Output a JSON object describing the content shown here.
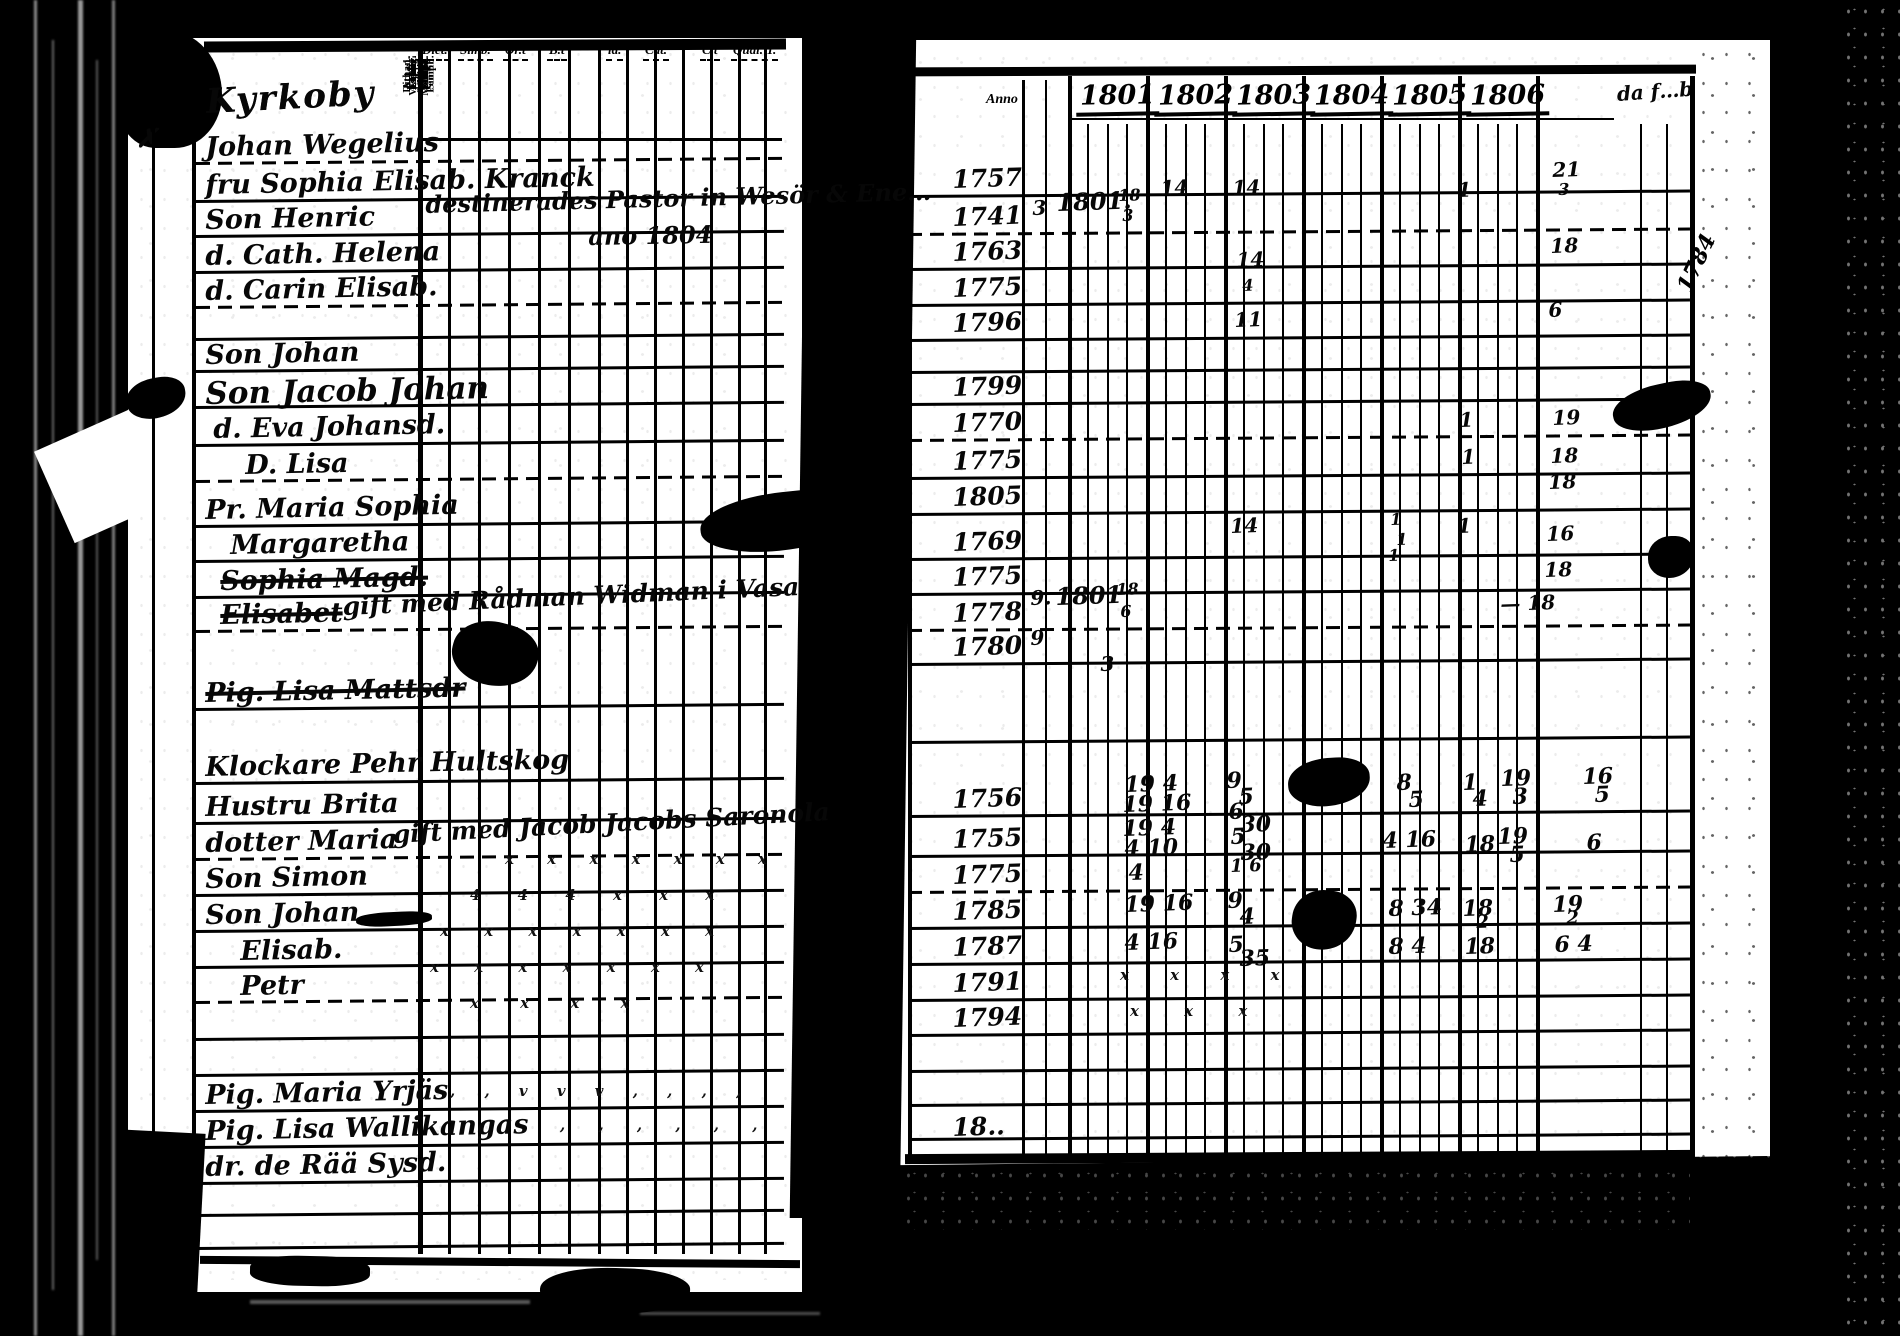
{
  "palette": {
    "film_black": "#000000",
    "paper_white": "#ffffff",
    "ink_black": "#070707"
  },
  "left_page": {
    "place_header": "Kyrkoby",
    "margin_cross": "✗",
    "group_labels": [
      {
        "text": "Dict.",
        "left": 420
      },
      {
        "text": "Simb.",
        "left": 458
      },
      {
        "text": "Or.t",
        "left": 503
      },
      {
        "text": "B.t",
        "left": 547
      },
      {
        "text": "lä.",
        "left": 606
      },
      {
        "text": "Cat.",
        "left": 643
      },
      {
        "text": "C.t",
        "left": 700
      },
      {
        "text": "Qual. T.",
        "left": 731
      }
    ],
    "rotated_columns": [
      "Explic.\nSimpl.",
      "Athan.\nExplic.\nSimpl.",
      "Explic.\nSimpl.",
      "Explic.\nSimpl.",
      "Explic.\nSimpl.",
      "Explic.\nSimpl.",
      "1.  2.  3.",
      "Thur.\nExpl.",
      "Utan.\nböned.",
      "Vespert.\nMatut.",
      "Dict. s.s.\nPennin.",
      "Allg. m."
    ],
    "annotations": [
      {
        "text": "destinerades Pastor in Wesör & Ene…",
        "x": 425,
        "y": 190,
        "size": 24,
        "rot": -1.5
      },
      {
        "text": "ano 1804",
        "x": 588,
        "y": 222,
        "size": 24,
        "rot": -1
      },
      {
        "text": "gift med Rådman Widman i Vasa",
        "x": 342,
        "y": 592,
        "size": 25,
        "rot": -2.5
      },
      {
        "text": "gift med Jacob Jacobs Saronola",
        "x": 392,
        "y": 820,
        "size": 25,
        "rot": -3
      }
    ],
    "checks": [
      {
        "t": "x  x x   x  x    x   x",
        "x": 505,
        "y": 850,
        "ls": 14
      },
      {
        "t": "4  4 4   x  x    x",
        "x": 470,
        "y": 886,
        "ls": 16
      },
      {
        "t": "x x  x   x x   x  x",
        "x": 440,
        "y": 922,
        "ls": 15
      },
      {
        "t": "x  x x x   x   x x",
        "x": 430,
        "y": 958,
        "ls": 15
      },
      {
        "t": "x x   x  x",
        "x": 470,
        "y": 994,
        "ls": 18
      },
      {
        "t": ", ,  v v v   , ,   , ,",
        "x": 450,
        "y": 1082,
        "ls": 12
      },
      {
        "t": ", ,   , ,    , ,",
        "x": 560,
        "y": 1116,
        "ls": 14
      },
      {
        "t": "x  x   x x",
        "x": 1120,
        "y": 966,
        "ls": 18
      },
      {
        "t": "x x    x",
        "x": 1130,
        "y": 1002,
        "ls": 20
      }
    ]
  },
  "right_page": {
    "anno_label": "Anno",
    "year_headers": [
      "1801",
      "1802",
      "1803",
      "1804",
      "1805",
      "1806"
    ],
    "last_column_label": "da f…b",
    "margin_notes": [
      {
        "text": "1784",
        "x": 1666,
        "y": 250,
        "rot": -65,
        "size": 22
      }
    ],
    "marks": [
      {
        "t": "3",
        "x": 1032,
        "y": 196
      },
      {
        "t": "1801.",
        "x": 1056,
        "y": 188,
        "s": 24
      },
      {
        "t": "18",
        "x": 1118,
        "y": 186,
        "s": 16
      },
      {
        "t": "3",
        "x": 1122,
        "y": 206,
        "s": 16
      },
      {
        "t": "14",
        "x": 1160,
        "y": 176
      },
      {
        "t": "14",
        "x": 1232,
        "y": 176
      },
      {
        "t": "14",
        "x": 1236,
        "y": 248
      },
      {
        "t": "4",
        "x": 1242,
        "y": 276,
        "s": 16
      },
      {
        "t": "11",
        "x": 1234,
        "y": 308
      },
      {
        "t": "1",
        "x": 1457,
        "y": 178
      },
      {
        "t": "21",
        "x": 1552,
        "y": 158
      },
      {
        "t": "3",
        "x": 1558,
        "y": 180,
        "s": 16
      },
      {
        "t": "18",
        "x": 1550,
        "y": 234
      },
      {
        "t": "6",
        "x": 1548,
        "y": 298
      },
      {
        "t": "1",
        "x": 1459,
        "y": 408
      },
      {
        "t": "19",
        "x": 1552,
        "y": 406
      },
      {
        "t": "1",
        "x": 1461,
        "y": 445
      },
      {
        "t": "18",
        "x": 1550,
        "y": 444
      },
      {
        "t": "18",
        "x": 1548,
        "y": 470
      },
      {
        "t": "14",
        "x": 1230,
        "y": 514
      },
      {
        "t": "1",
        "x": 1390,
        "y": 510,
        "s": 16
      },
      {
        "t": "1",
        "x": 1396,
        "y": 530,
        "s": 16
      },
      {
        "t": "1",
        "x": 1457,
        "y": 514
      },
      {
        "t": "16",
        "x": 1546,
        "y": 522
      },
      {
        "t": "1",
        "x": 1388,
        "y": 546,
        "s": 16
      },
      {
        "t": "18",
        "x": 1544,
        "y": 558
      },
      {
        "t": "9.",
        "x": 1030,
        "y": 586
      },
      {
        "t": "1801",
        "x": 1055,
        "y": 582,
        "s": 24
      },
      {
        "t": "18",
        "x": 1116,
        "y": 580,
        "s": 16
      },
      {
        "t": "6",
        "x": 1120,
        "y": 602,
        "s": 16
      },
      {
        "t": "— 18",
        "x": 1500,
        "y": 592
      },
      {
        "t": "9",
        "x": 1030,
        "y": 626
      },
      {
        "t": "3",
        "x": 1100,
        "y": 652
      },
      {
        "t": "19 4",
        "x": 1124,
        "y": 772,
        "s": 22
      },
      {
        "t": "19 16",
        "x": 1122,
        "y": 792,
        "s": 22
      },
      {
        "t": "9",
        "x": 1226,
        "y": 768,
        "s": 22
      },
      {
        "t": "5",
        "x": 1238,
        "y": 784,
        "s": 22
      },
      {
        "t": "6",
        "x": 1228,
        "y": 799,
        "s": 22
      },
      {
        "t": "30",
        "x": 1240,
        "y": 812,
        "s": 22
      },
      {
        "t": "8",
        "x": 1396,
        "y": 770,
        "s": 22
      },
      {
        "t": "5",
        "x": 1408,
        "y": 787,
        "s": 22
      },
      {
        "t": "1",
        "x": 1462,
        "y": 770,
        "s": 22
      },
      {
        "t": "4",
        "x": 1472,
        "y": 786,
        "s": 22
      },
      {
        "t": "19",
        "x": 1500,
        "y": 766,
        "s": 22
      },
      {
        "t": "3",
        "x": 1512,
        "y": 784,
        "s": 22
      },
      {
        "t": "16",
        "x": 1582,
        "y": 764,
        "s": 22
      },
      {
        "t": "5",
        "x": 1594,
        "y": 782,
        "s": 22
      },
      {
        "t": "19 4",
        "x": 1122,
        "y": 816,
        "s": 22
      },
      {
        "t": "4 10",
        "x": 1124,
        "y": 836,
        "s": 22
      },
      {
        "t": "5",
        "x": 1230,
        "y": 824,
        "s": 22
      },
      {
        "t": "30",
        "x": 1240,
        "y": 840,
        "s": 22
      },
      {
        "t": "4 16",
        "x": 1382,
        "y": 828,
        "s": 22
      },
      {
        "t": "18",
        "x": 1464,
        "y": 832,
        "s": 22
      },
      {
        "t": "19",
        "x": 1497,
        "y": 824,
        "s": 22
      },
      {
        "t": "5",
        "x": 1509,
        "y": 842,
        "s": 22
      },
      {
        "t": "6",
        "x": 1586,
        "y": 830,
        "s": 22
      },
      {
        "t": "4",
        "x": 1128,
        "y": 860,
        "s": 22
      },
      {
        "t": "1 6",
        "x": 1230,
        "y": 856,
        "s": 18
      },
      {
        "t": "19 16",
        "x": 1124,
        "y": 892,
        "s": 22
      },
      {
        "t": "9",
        "x": 1227,
        "y": 888,
        "s": 22
      },
      {
        "t": "4",
        "x": 1239,
        "y": 904,
        "s": 22
      },
      {
        "t": "8 34",
        "x": 1388,
        "y": 896,
        "s": 22
      },
      {
        "t": "18",
        "x": 1462,
        "y": 896,
        "s": 22
      },
      {
        "t": "2",
        "x": 1476,
        "y": 912,
        "s": 18
      },
      {
        "t": "19",
        "x": 1552,
        "y": 892,
        "s": 22
      },
      {
        "t": "2",
        "x": 1566,
        "y": 908,
        "s": 18
      },
      {
        "t": "4 16",
        "x": 1124,
        "y": 930,
        "s": 22
      },
      {
        "t": "5",
        "x": 1228,
        "y": 932,
        "s": 22
      },
      {
        "t": "35",
        "x": 1239,
        "y": 946,
        "s": 22
      },
      {
        "t": "8 4",
        "x": 1388,
        "y": 934,
        "s": 22
      },
      {
        "t": "18",
        "x": 1464,
        "y": 934,
        "s": 22
      },
      {
        "t": "6 4",
        "x": 1554,
        "y": 932,
        "s": 22
      }
    ]
  },
  "rows": [
    {
      "top": 82,
      "name": "Kyrkoby",
      "year": "",
      "cls": "place"
    },
    {
      "top": 132,
      "name": "Johan Wegelius",
      "year": "1757"
    },
    {
      "top": 170,
      "name": "fru Sophia Elisab. Kranck",
      "year": "1741"
    },
    {
      "top": 205,
      "name": "Son Henric",
      "year": "1763"
    },
    {
      "top": 241,
      "name": "d. Cath. Helena",
      "year": "1775"
    },
    {
      "top": 276,
      "name": "d. Carin Elisab.",
      "year": "1796"
    },
    {
      "top": 340,
      "name": "Son Johan",
      "year": "1799"
    },
    {
      "top": 376,
      "name": "Son Jacob Johan",
      "year": "1770",
      "cls": "big"
    },
    {
      "top": 414,
      "name": "d. Eva Johansd.",
      "year": "1775",
      "indent": 8
    },
    {
      "top": 450,
      "name": "D. Lisa",
      "year": "1805",
      "indent": 40
    },
    {
      "top": 495,
      "name": "Pr. Maria Sophia",
      "year": "1769"
    },
    {
      "top": 530,
      "name": "Margaretha",
      "year": "1775",
      "indent": 25
    },
    {
      "top": 566,
      "name": "Sophia Magd.",
      "year": "1778",
      "struck": true,
      "indent": 15
    },
    {
      "top": 600,
      "name": "Elisabet",
      "year": "1780",
      "struck": true,
      "indent": 15
    },
    {
      "top": 678,
      "name": "Pig. Lisa Mattsdr",
      "year": "",
      "struck": true
    },
    {
      "top": 752,
      "name": "Klockare Pehr Hultskog",
      "year": "1756"
    },
    {
      "top": 792,
      "name": "Hustru Brita",
      "year": "1755"
    },
    {
      "top": 828,
      "name": "dotter Maria",
      "year": "1775"
    },
    {
      "top": 864,
      "name": "Son Simon",
      "year": "1785"
    },
    {
      "top": 900,
      "name": "Son Johan",
      "year": "1787"
    },
    {
      "top": 936,
      "name": "Elisab.",
      "year": "1791",
      "indent": 35
    },
    {
      "top": 971,
      "name": "Petr",
      "year": "1794",
      "indent": 35
    },
    {
      "top": 1080,
      "name": "Pig. Maria Yrjäs",
      "year": "18.."
    },
    {
      "top": 1116,
      "name": "Pig. Lisa Wallikangas",
      "year": ""
    },
    {
      "top": 1152,
      "name": "dr. de Rää Sysd.",
      "year": ""
    }
  ]
}
